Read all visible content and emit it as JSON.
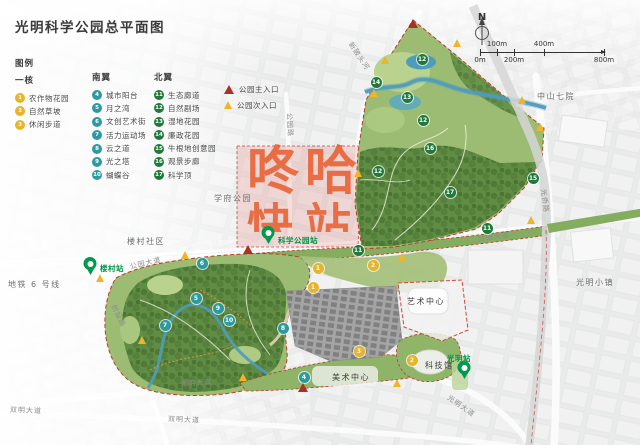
{
  "title": "光明科学公园总平面图",
  "legend": {
    "heading": "图例",
    "sections": [
      {
        "name": "一核",
        "color": "#e9b32a",
        "items": [
          {
            "num": "1",
            "label": "农作物花园"
          },
          {
            "num": "2",
            "label": "自然草坡"
          },
          {
            "num": "3",
            "label": "休闲步道"
          }
        ]
      },
      {
        "name": "南翼",
        "color": "#2d9aa0",
        "items": [
          {
            "num": "4",
            "label": "城市阳台"
          },
          {
            "num": "5",
            "label": "月之湾"
          },
          {
            "num": "6",
            "label": "文创艺术街"
          },
          {
            "num": "7",
            "label": "活力运动场"
          },
          {
            "num": "8",
            "label": "云之道"
          },
          {
            "num": "9",
            "label": "光之塔"
          },
          {
            "num": "10",
            "label": "蝴蝶谷"
          }
        ]
      },
      {
        "name": "北翼",
        "color": "#20793a",
        "items": [
          {
            "num": "11",
            "label": "生态廊道"
          },
          {
            "num": "12",
            "label": "自然剧场"
          },
          {
            "num": "13",
            "label": "湿地花园"
          },
          {
            "num": "14",
            "label": "廉政花园"
          },
          {
            "num": "15",
            "label": "牛根地创意园"
          },
          {
            "num": "16",
            "label": "观景步廊"
          },
          {
            "num": "17",
            "label": "科学顶"
          }
        ]
      }
    ],
    "entrances": [
      {
        "type": "main",
        "label": "公园主入口"
      },
      {
        "type": "secondary",
        "label": "公园次入口"
      }
    ]
  },
  "compass": {
    "label": "N"
  },
  "scalebar": {
    "ticks": [
      {
        "label": "0m",
        "pos": 0,
        "side": "below"
      },
      {
        "label": "100m",
        "pos": 17,
        "side": "above"
      },
      {
        "label": "200m",
        "pos": 34,
        "side": "below"
      },
      {
        "label": "400m",
        "pos": 64,
        "side": "above"
      },
      {
        "label": "800m",
        "pos": 124,
        "side": "below"
      }
    ]
  },
  "watermark": {
    "line1": "咚哈",
    "line2": "快站",
    "color": "#e85422"
  },
  "colors": {
    "marker": {
      "core": "#e9b32a",
      "south": "#2d9aa0",
      "north": "#20793a"
    },
    "entrance": {
      "main": "#a93226",
      "secondary": "#f0b429"
    },
    "station": "#009a4e",
    "station_text": "#00914a"
  },
  "map": {
    "labels": [
      {
        "text": "学府公园",
        "x": 214,
        "y": 193,
        "rot": 0,
        "kind": "area"
      },
      {
        "text": "楼村社区",
        "x": 127,
        "y": 236,
        "rot": 0,
        "kind": "area"
      },
      {
        "text": "中山七院",
        "x": 537,
        "y": 91,
        "rot": 0,
        "kind": "area"
      },
      {
        "text": "光明小镇",
        "x": 576,
        "y": 277,
        "rot": 0,
        "kind": "area"
      },
      {
        "text": "地铁 6 号线",
        "x": 8,
        "y": 279,
        "rot": 0,
        "kind": "area"
      },
      {
        "text": "艺术中心",
        "x": 407,
        "y": 296,
        "rot": 0,
        "kind": "poi"
      },
      {
        "text": "科技馆",
        "x": 425,
        "y": 360,
        "rot": 0,
        "kind": "poi"
      },
      {
        "text": "美术中心",
        "x": 332,
        "y": 372,
        "rot": 0,
        "kind": "poi"
      },
      {
        "text": "公园大道",
        "x": 130,
        "y": 262,
        "rot": -13,
        "kind": "road"
      },
      {
        "text": "公园大道",
        "x": 478,
        "y": 234,
        "rot": -7,
        "kind": "road"
      },
      {
        "text": "公园路",
        "x": 289,
        "y": 108,
        "rot": 87,
        "kind": "road"
      },
      {
        "text": "光侨路",
        "x": 543,
        "y": 184,
        "rot": 82,
        "kind": "road"
      },
      {
        "text": "创投路",
        "x": 113,
        "y": 300,
        "rot": 64,
        "kind": "road"
      },
      {
        "text": "新陂头河",
        "x": 350,
        "y": 38,
        "rot": 56,
        "kind": "road"
      },
      {
        "text": "光明大道",
        "x": 180,
        "y": 379,
        "rot": -3,
        "kind": "road"
      },
      {
        "text": "双明大道",
        "x": 168,
        "y": 414,
        "rot": 3,
        "kind": "road"
      },
      {
        "text": "双明大道",
        "x": 10,
        "y": 405,
        "rot": 2,
        "kind": "road"
      },
      {
        "text": "光明大道",
        "x": 448,
        "y": 392,
        "rot": 35,
        "kind": "road"
      }
    ],
    "stations": [
      {
        "name": "楼村站",
        "x": 90,
        "y": 276,
        "lx": 100,
        "ly": 263
      },
      {
        "name": "科学公园站",
        "x": 268,
        "y": 245,
        "lx": 278,
        "ly": 235
      },
      {
        "name": "光明站",
        "x": 464,
        "y": 380,
        "lx": 447,
        "ly": 353
      }
    ],
    "markers": [
      {
        "t": "core",
        "n": "1",
        "x": 318,
        "y": 268
      },
      {
        "t": "core",
        "n": "2",
        "x": 373,
        "y": 265
      },
      {
        "t": "core",
        "n": "1",
        "x": 313,
        "y": 287
      },
      {
        "t": "core",
        "n": "3",
        "x": 359,
        "y": 351
      },
      {
        "t": "core",
        "n": "2",
        "x": 412,
        "y": 360
      },
      {
        "t": "south",
        "n": "4",
        "x": 304,
        "y": 377
      },
      {
        "t": "south",
        "n": "5",
        "x": 196,
        "y": 298
      },
      {
        "t": "south",
        "n": "6",
        "x": 202,
        "y": 263
      },
      {
        "t": "south",
        "n": "7",
        "x": 165,
        "y": 325
      },
      {
        "t": "south",
        "n": "8",
        "x": 283,
        "y": 328
      },
      {
        "t": "south",
        "n": "9",
        "x": 218,
        "y": 308
      },
      {
        "t": "south",
        "n": "10",
        "x": 229,
        "y": 320
      },
      {
        "t": "north",
        "n": "11",
        "x": 358,
        "y": 250
      },
      {
        "t": "north",
        "n": "11",
        "x": 487,
        "y": 228
      },
      {
        "t": "north",
        "n": "12",
        "x": 422,
        "y": 59
      },
      {
        "t": "north",
        "n": "12",
        "x": 378,
        "y": 171
      },
      {
        "t": "north",
        "n": "12",
        "x": 423,
        "y": 120
      },
      {
        "t": "north",
        "n": "13",
        "x": 407,
        "y": 97
      },
      {
        "t": "north",
        "n": "14",
        "x": 376,
        "y": 82
      },
      {
        "t": "north",
        "n": "15",
        "x": 533,
        "y": 178
      },
      {
        "t": "north",
        "n": "16",
        "x": 430,
        "y": 148
      },
      {
        "t": "north",
        "n": "17",
        "x": 450,
        "y": 192
      }
    ],
    "entrances": [
      {
        "t": "main",
        "x": 413,
        "y": 24
      },
      {
        "t": "main",
        "x": 248,
        "y": 250
      },
      {
        "t": "main",
        "x": 303,
        "y": 388
      },
      {
        "t": "secondary",
        "x": 457,
        "y": 43
      },
      {
        "t": "secondary",
        "x": 385,
        "y": 60
      },
      {
        "t": "secondary",
        "x": 374,
        "y": 93
      },
      {
        "t": "secondary",
        "x": 522,
        "y": 100
      },
      {
        "t": "secondary",
        "x": 540,
        "y": 127
      },
      {
        "t": "secondary",
        "x": 358,
        "y": 173
      },
      {
        "t": "secondary",
        "x": 531,
        "y": 220
      },
      {
        "t": "secondary",
        "x": 402,
        "y": 257
      },
      {
        "t": "secondary",
        "x": 185,
        "y": 255
      },
      {
        "t": "secondary",
        "x": 100,
        "y": 278
      },
      {
        "t": "secondary",
        "x": 142,
        "y": 340
      },
      {
        "t": "secondary",
        "x": 243,
        "y": 377
      },
      {
        "t": "secondary",
        "x": 397,
        "y": 383
      }
    ]
  }
}
